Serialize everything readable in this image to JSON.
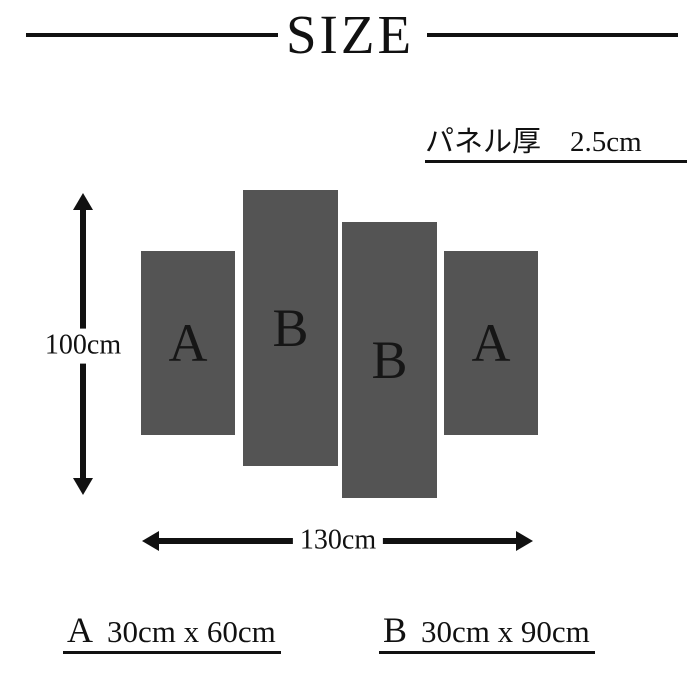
{
  "header": {
    "title": "SIZE"
  },
  "thickness_note": "パネル厚　2.5cm",
  "diagram": {
    "panels": [
      {
        "id": "A-left",
        "label": "A",
        "size": "30cm x 60cm"
      },
      {
        "id": "B-left",
        "label": "B",
        "size": "30cm x 90cm"
      },
      {
        "id": "B-right",
        "label": "B",
        "size": "30cm x 90cm"
      },
      {
        "id": "A-right",
        "label": "A",
        "size": "30cm x 60cm"
      }
    ],
    "height_arrow_label": "100cm",
    "width_arrow_label": "130cm"
  },
  "legend": [
    {
      "letter": "A",
      "dimensions": "30cm x 60cm"
    },
    {
      "letter": "B",
      "dimensions": "30cm x 90cm"
    }
  ],
  "colors": {
    "panel": "#545454",
    "text": "#111111",
    "background": "#ffffff"
  }
}
